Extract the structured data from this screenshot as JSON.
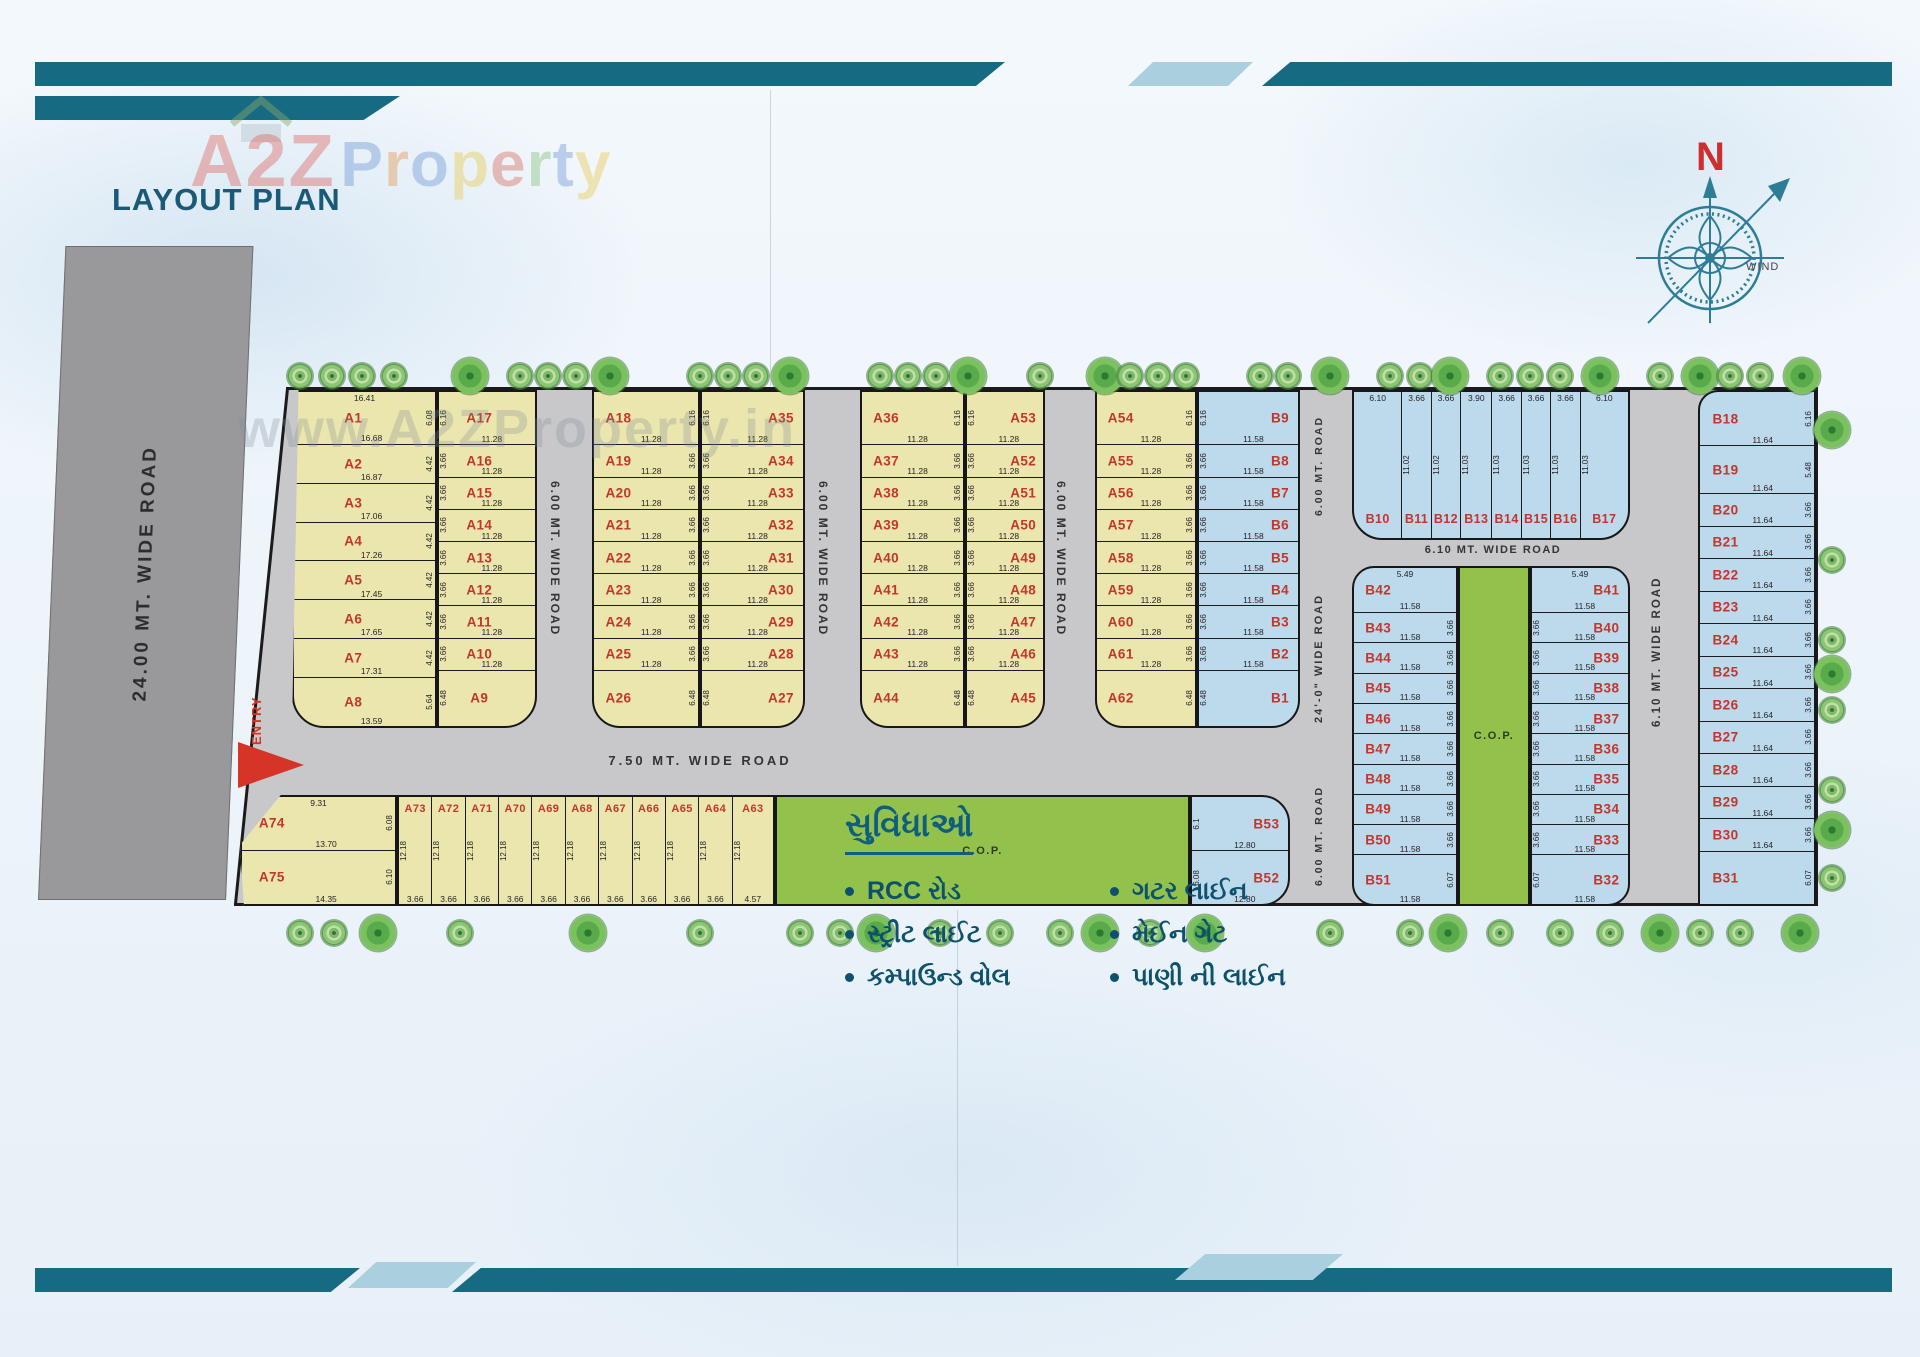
{
  "header": {
    "title": "LAYOUT PLAN",
    "brand_a": "A2Z",
    "brand_property": "Property",
    "plan_watermark": "www.A2ZProperty.in"
  },
  "compass": {
    "north": "N",
    "wind": "WIND"
  },
  "roads": {
    "left": "24.00 MT. WIDE ROAD",
    "v1": "6.00 MT. WIDE ROAD",
    "v2": "6.00 MT. WIDE ROAD",
    "v3": "6.00 MT. WIDE ROAD",
    "right_top": "6.00 MT. ROAD",
    "right_mid": "24'-0\" WIDE ROAD",
    "right_bottom": "6.00 MT. ROAD",
    "h_main": "7.50 MT. WIDE ROAD",
    "h_b": "6.10 MT. WIDE ROAD",
    "v_b": "6.10 MT. WIDE ROAD",
    "entry": "ENTRY"
  },
  "cop_label": "C.O.P.",
  "amenities": {
    "heading": "સુવિધાઓ",
    "items_left": [
      "RCC રોડ",
      "સ્ટ્રીટ લાઈટ",
      "કમ્પાઉન્ડ વોલ"
    ],
    "items_right": [
      "ગટર લાઈન",
      "મેઈન ગેટ",
      "પાણી ની લાઈન"
    ]
  },
  "colors": {
    "frame_teal": "#166a82",
    "accent_blue": "#aacfdf",
    "plot_yellow": "#ebe6ae",
    "plot_blue": "#bdd9ec",
    "cop_green": "#93c24c",
    "road_gray": "#c8c8ca",
    "label_red": "#c2362b",
    "heading_teal": "#0f5e7d"
  },
  "plan": {
    "groups": {
      "b1l": [
        {
          "l": "A1",
          "t": "16.41",
          "b": "16.68",
          "s": "6.08"
        },
        {
          "l": "A2",
          "b": "16.87",
          "s": "4.42"
        },
        {
          "l": "A3",
          "b": "17.06",
          "s": "4.42"
        },
        {
          "l": "A4",
          "b": "17.26",
          "s": "4.42"
        },
        {
          "l": "A5",
          "b": "17.45",
          "s": "4.42"
        },
        {
          "l": "A6",
          "b": "17.65",
          "s": "4.42"
        },
        {
          "l": "A7",
          "b": "17.31",
          "s": "4.42"
        },
        {
          "l": "A8",
          "b": "13.59",
          "s": "5.64"
        }
      ],
      "b1r": [
        {
          "l": "A17",
          "b": "11.28",
          "s": "6.16"
        },
        {
          "l": "A16",
          "b": "11.28",
          "s": "3.66"
        },
        {
          "l": "A15",
          "b": "11.28",
          "s": "3.66"
        },
        {
          "l": "A14",
          "b": "11.28",
          "s": "3.66"
        },
        {
          "l": "A13",
          "b": "11.28",
          "s": "3.66"
        },
        {
          "l": "A12",
          "b": "11.28",
          "s": "3.66"
        },
        {
          "l": "A11",
          "b": "11.28",
          "s": "3.66"
        },
        {
          "l": "A10",
          "b": "11.28",
          "s": "3.66"
        },
        {
          "l": "A9",
          "s": "6.48"
        }
      ],
      "b2l": [
        {
          "l": "A18",
          "b": "11.28",
          "s": "6.16"
        },
        {
          "l": "A19",
          "b": "11.28",
          "s": "3.66"
        },
        {
          "l": "A20",
          "b": "11.28",
          "s": "3.66"
        },
        {
          "l": "A21",
          "b": "11.28",
          "s": "3.66"
        },
        {
          "l": "A22",
          "b": "11.28",
          "s": "3.66"
        },
        {
          "l": "A23",
          "b": "11.28",
          "s": "3.66"
        },
        {
          "l": "A24",
          "b": "11.28",
          "s": "3.66"
        },
        {
          "l": "A25",
          "b": "11.28",
          "s": "3.66"
        },
        {
          "l": "A26",
          "s": "6.48"
        }
      ],
      "b2r": [
        {
          "l": "A35",
          "b": "11.28",
          "s": "6.16"
        },
        {
          "l": "A34",
          "b": "11.28",
          "s": "3.66"
        },
        {
          "l": "A33",
          "b": "11.28",
          "s": "3.66"
        },
        {
          "l": "A32",
          "b": "11.28",
          "s": "3.66"
        },
        {
          "l": "A31",
          "b": "11.28",
          "s": "3.66"
        },
        {
          "l": "A30",
          "b": "11.28",
          "s": "3.66"
        },
        {
          "l": "A29",
          "b": "11.28",
          "s": "3.66"
        },
        {
          "l": "A28",
          "b": "11.28",
          "s": "3.66"
        },
        {
          "l": "A27",
          "s": "6.48"
        }
      ],
      "b3l": [
        {
          "l": "A36",
          "b": "11.28",
          "s": "6.16"
        },
        {
          "l": "A37",
          "b": "11.28",
          "s": "3.66"
        },
        {
          "l": "A38",
          "b": "11.28",
          "s": "3.66"
        },
        {
          "l": "A39",
          "b": "11.28",
          "s": "3.66"
        },
        {
          "l": "A40",
          "b": "11.28",
          "s": "3.66"
        },
        {
          "l": "A41",
          "b": "11.28",
          "s": "3.66"
        },
        {
          "l": "A42",
          "b": "11.28",
          "s": "3.66"
        },
        {
          "l": "A43",
          "b": "11.28",
          "s": "3.66"
        },
        {
          "l": "A44",
          "s": "6.48"
        }
      ],
      "b3r": [
        {
          "l": "A53",
          "b": "11.28",
          "s": "6.16"
        },
        {
          "l": "A52",
          "b": "11.28",
          "s": "3.66"
        },
        {
          "l": "A51",
          "b": "11.28",
          "s": "3.66"
        },
        {
          "l": "A50",
          "b": "11.28",
          "s": "3.66"
        },
        {
          "l": "A49",
          "b": "11.28",
          "s": "3.66"
        },
        {
          "l": "A48",
          "b": "11.28",
          "s": "3.66"
        },
        {
          "l": "A47",
          "b": "11.28",
          "s": "3.66"
        },
        {
          "l": "A46",
          "b": "11.28",
          "s": "3.66"
        },
        {
          "l": "A45",
          "s": "6.48"
        }
      ],
      "b4l": [
        {
          "l": "A54",
          "b": "11.28",
          "s": "6.16"
        },
        {
          "l": "A55",
          "b": "11.28",
          "s": "3.66"
        },
        {
          "l": "A56",
          "b": "11.28",
          "s": "3.66"
        },
        {
          "l": "A57",
          "b": "11.28",
          "s": "3.66"
        },
        {
          "l": "A58",
          "b": "11.28",
          "s": "3.66"
        },
        {
          "l": "A59",
          "b": "11.28",
          "s": "3.66"
        },
        {
          "l": "A60",
          "b": "11.28",
          "s": "3.66"
        },
        {
          "l": "A61",
          "b": "11.28",
          "s": "3.66"
        },
        {
          "l": "A62",
          "s": "6.48"
        }
      ],
      "b4r": [
        {
          "l": "B9",
          "b": "11.58",
          "s": "6.16"
        },
        {
          "l": "B8",
          "b": "11.58",
          "s": "3.66"
        },
        {
          "l": "B7",
          "b": "11.58",
          "s": "3.66"
        },
        {
          "l": "B6",
          "b": "11.58",
          "s": "3.66"
        },
        {
          "l": "B5",
          "b": "11.58",
          "s": "3.66"
        },
        {
          "l": "B4",
          "b": "11.58",
          "s": "3.66"
        },
        {
          "l": "B3",
          "b": "11.58",
          "s": "3.66"
        },
        {
          "l": "B2",
          "b": "11.58",
          "s": "3.66"
        },
        {
          "l": "B1",
          "s": "6.48"
        }
      ],
      "b10": [
        {
          "l": "B10",
          "t": "6.10"
        },
        {
          "l": "B11",
          "t": "3.66",
          "s": "11.02"
        },
        {
          "l": "B12",
          "t": "3.66",
          "s": "11.02"
        },
        {
          "l": "B13",
          "t": "3.90",
          "s": "11.03"
        },
        {
          "l": "B14",
          "t": "3.66",
          "s": "11.03"
        },
        {
          "l": "B15",
          "t": "3.66",
          "s": "11.03"
        },
        {
          "l": "B16",
          "t": "3.66",
          "s": "11.03"
        },
        {
          "l": "B17",
          "t": "6.10",
          "s": "11.03"
        }
      ],
      "b42": [
        {
          "l": "B42",
          "t": "5.49",
          "b": "11.58"
        },
        {
          "l": "B43",
          "b": "11.58",
          "s": "3.66"
        },
        {
          "l": "B44",
          "b": "11.58",
          "s": "3.66"
        },
        {
          "l": "B45",
          "b": "11.58",
          "s": "3.66"
        },
        {
          "l": "B46",
          "b": "11.58",
          "s": "3.66"
        },
        {
          "l": "B47",
          "b": "11.58",
          "s": "3.66"
        },
        {
          "l": "B48",
          "b": "11.58",
          "s": "3.66"
        },
        {
          "l": "B49",
          "b": "11.58",
          "s": "3.66"
        },
        {
          "l": "B50",
          "b": "11.58",
          "s": "3.66"
        },
        {
          "l": "B51",
          "b": "11.58",
          "s": "6.07"
        }
      ],
      "b32": [
        {
          "l": "B41",
          "t": "5.49",
          "b": "11.58"
        },
        {
          "l": "B40",
          "b": "11.58",
          "s": "3.66"
        },
        {
          "l": "B39",
          "b": "11.58",
          "s": "3.66"
        },
        {
          "l": "B38",
          "b": "11.58",
          "s": "3.66"
        },
        {
          "l": "B37",
          "b": "11.58",
          "s": "3.66"
        },
        {
          "l": "B36",
          "b": "11.58",
          "s": "3.66"
        },
        {
          "l": "B35",
          "b": "11.58",
          "s": "3.66"
        },
        {
          "l": "B34",
          "b": "11.58",
          "s": "3.66"
        },
        {
          "l": "B33",
          "b": "11.58",
          "s": "3.66"
        },
        {
          "l": "B32",
          "b": "11.58",
          "s": "6.07"
        }
      ],
      "b18": [
        {
          "l": "B18",
          "b": "11.64",
          "s": "6.16"
        },
        {
          "l": "B19",
          "b": "11.64",
          "s": "5.48"
        },
        {
          "l": "B20",
          "b": "11.64",
          "s": "3.66"
        },
        {
          "l": "B21",
          "b": "11.64",
          "s": "3.66"
        },
        {
          "l": "B22",
          "b": "11.64",
          "s": "3.66"
        },
        {
          "l": "B23",
          "b": "11.64",
          "s": "3.66"
        },
        {
          "l": "B24",
          "b": "11.64",
          "s": "3.66"
        },
        {
          "l": "B25",
          "b": "11.64",
          "s": "3.66"
        },
        {
          "l": "B26",
          "b": "11.64",
          "s": "3.66"
        },
        {
          "l": "B27",
          "b": "11.64",
          "s": "3.66"
        },
        {
          "l": "B28",
          "b": "11.64",
          "s": "3.66"
        },
        {
          "l": "B29",
          "b": "11.64",
          "s": "3.66"
        },
        {
          "l": "B30",
          "b": "11.64",
          "s": "3.66"
        },
        {
          "l": "B31",
          "s": "6.07"
        }
      ],
      "a74": [
        {
          "l": "A74",
          "t": "9.31",
          "b": "13.70",
          "s": "6.08"
        },
        {
          "l": "A75",
          "b": "14.35",
          "s": "6.10"
        }
      ],
      "strips": [
        {
          "l": "A73",
          "s": "12.18",
          "b": "3.66"
        },
        {
          "l": "A72",
          "s": "12.18",
          "b": "3.66"
        },
        {
          "l": "A71",
          "s": "12.18",
          "b": "3.66"
        },
        {
          "l": "A70",
          "s": "12.18",
          "b": "3.66"
        },
        {
          "l": "A69",
          "s": "12.18",
          "b": "3.66"
        },
        {
          "l": "A68",
          "s": "12.18",
          "b": "3.66"
        },
        {
          "l": "A67",
          "s": "12.18",
          "b": "3.66"
        },
        {
          "l": "A66",
          "s": "12.18",
          "b": "3.66"
        },
        {
          "l": "A65",
          "s": "12.18",
          "b": "3.66"
        },
        {
          "l": "A64",
          "s": "12.18",
          "b": "3.66"
        },
        {
          "l": "A63",
          "s": "12.18",
          "b": "4.57"
        }
      ],
      "b52": [
        {
          "l": "B53",
          "b": "12.80",
          "s": "6.1"
        },
        {
          "l": "B52",
          "b": "12.80",
          "s": "6.08"
        }
      ]
    }
  }
}
